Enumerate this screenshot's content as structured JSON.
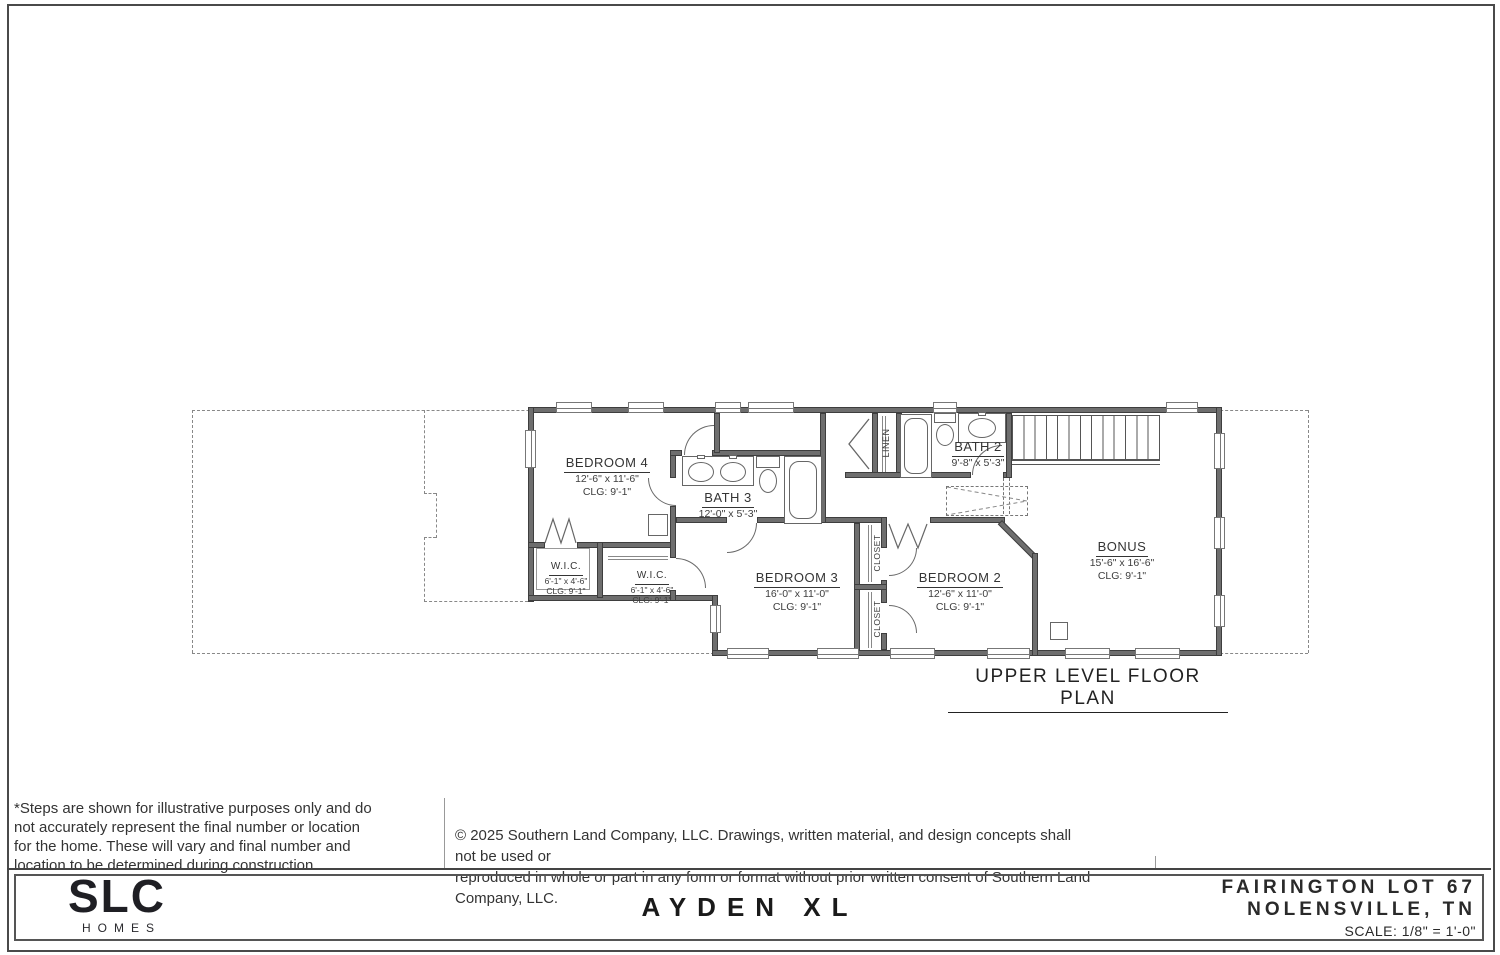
{
  "sheet": {
    "plan_title": "UPPER LEVEL FLOOR PLAN",
    "model_name": "AYDEN XL",
    "brand": {
      "name": "SLC",
      "sub": "HOMES"
    },
    "project": {
      "line1": "FAIRINGTON LOT 67",
      "line2": "NOLENSVILLE, TN",
      "scale": "SCALE: 1/8\" = 1'-0\""
    },
    "notes": {
      "disclaimer_lines": [
        "*Steps are shown for illustrative purposes only and do",
        "not accurately represent the final number or location",
        "for the home.  These will vary and final number and",
        "location to be determined during construction."
      ],
      "copyright_lines": [
        "© 2025 Southern Land Company, LLC. Drawings, written material, and design concepts shall not be used or",
        "reproduced in whole or part in any form or format without prior written consent of Southern Land Company, LLC."
      ]
    }
  },
  "rooms": [
    {
      "name": "BEDROOM 4",
      "dims": "12'-6\" x 11'-6\"",
      "clg": "CLG:  9'-1\""
    },
    {
      "name": "BATH 3",
      "dims": "12'-0\" x 5'-3\"",
      "clg": ""
    },
    {
      "name": "W.I.C.",
      "dims": "6'-1\" x 4'-6\"",
      "clg": "CLG:  9'-1\""
    },
    {
      "name": "W.I.C.",
      "dims": "6'-1\" x 4'-6\"",
      "clg": "CLG:  9'-1\""
    },
    {
      "name": "BEDROOM 3",
      "dims": "16'-0\" x 11'-0\"",
      "clg": "CLG:  9'-1\""
    },
    {
      "name": "BEDROOM 2",
      "dims": "12'-6\" x 11'-0\"",
      "clg": "CLG:  9'-1\""
    },
    {
      "name": "BATH 2",
      "dims": "9'-8\" x 5'-3\"",
      "clg": ""
    },
    {
      "name": "BONUS",
      "dims": "15'-6\" x 16'-6\"",
      "clg": "CLG:  9'-1\""
    }
  ],
  "closets": {
    "linen": "LINEN",
    "closet_upper": "CLOSET",
    "closet_lower": "CLOSET"
  }
}
